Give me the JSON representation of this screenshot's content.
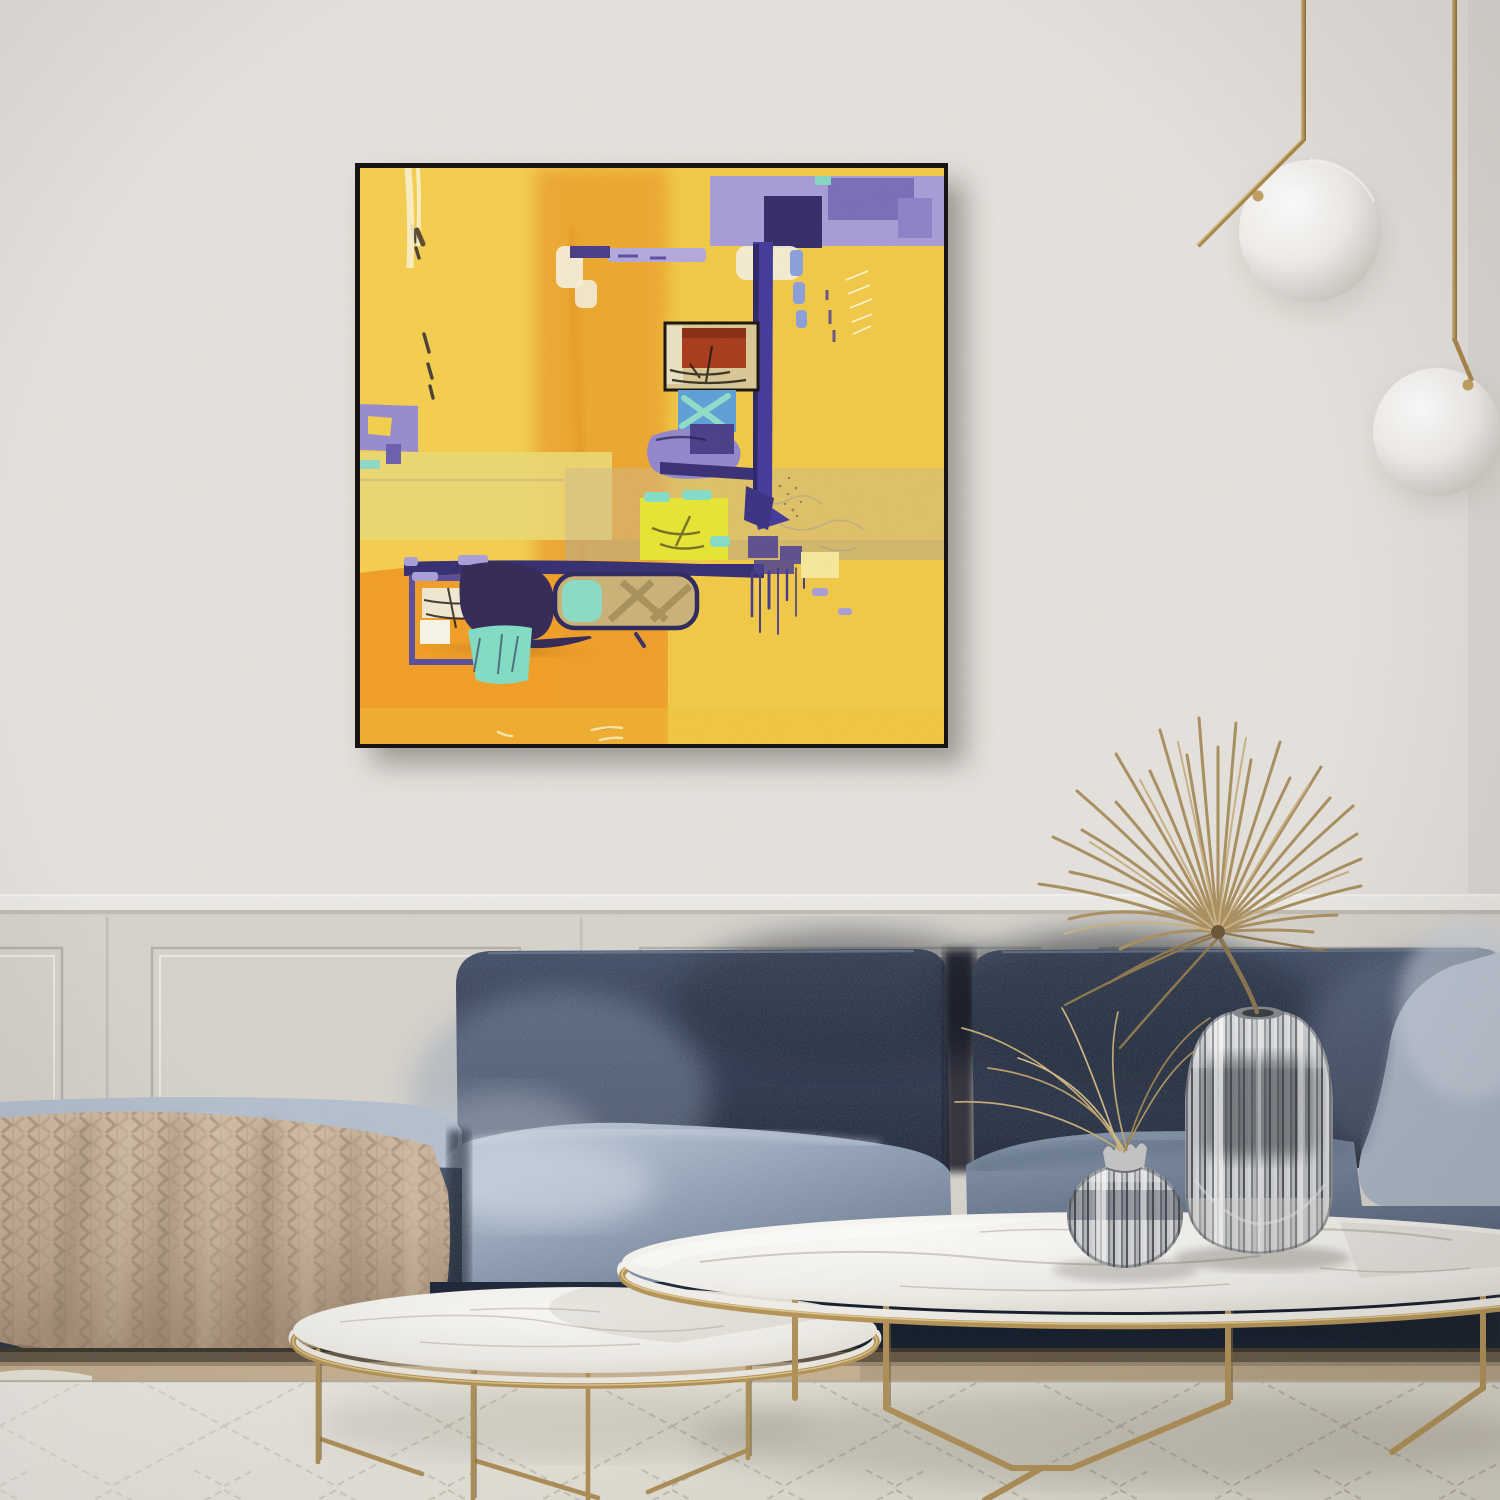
{
  "scene": {
    "kind": "living-room interior photograph, no visible text or UI",
    "width": 1500,
    "height": 1500
  },
  "objects": {
    "wall": "flat light-grey wall with chair rail and panelled wainscoting",
    "artwork": "square abstract painting (yellow, orange, violet, teal, red) in thin black frame",
    "pendant_left": "brass rod pendant lamp with white glass sphere",
    "pendant_right": "brass rod pendant lamp with white glass sphere",
    "sofa": "navy-blue velvet modular sofa",
    "blanket": "beige chunky-knit throw draped over chaise",
    "table_large": "oval white marble coffee table with brass frame base",
    "table_small": "round white marble nesting table with brass frame base",
    "vase_tall": "tall ribbed smoked-glass vase holding dried palm fan",
    "vase_small": "round ribbed smoked-glass vase holding dried grass",
    "plant": "dried palm fan and grass stems",
    "rug": "ivory rug with thin grey diamond lattice",
    "floor": "light herringbone wood floor strip"
  },
  "palette": {
    "wall": "#e4e1dc",
    "rail": "#eae8e3",
    "wainscot": "#d6d2cb",
    "frame": "#131211",
    "canvas_yellow": "#f1c847",
    "canvas_orange": "#eda42f",
    "canvas_indigo": "#453a99",
    "canvas_lavender": "#a79dd6",
    "canvas_teal": "#82dcc4",
    "canvas_red": "#a93b1d",
    "canvas_chartreuse": "#e6e434",
    "sofa_navy": "#222c42",
    "sofa_light": "#9fb0c4",
    "blanket": "#c8b29a",
    "gold": "#b3935a",
    "marble": "#f4f2ee",
    "rug": "#e8e4d8",
    "floor": "#c9b595",
    "plinth": "#665949",
    "plant": "#b59c6d",
    "sphere": "#f6f4f0"
  }
}
